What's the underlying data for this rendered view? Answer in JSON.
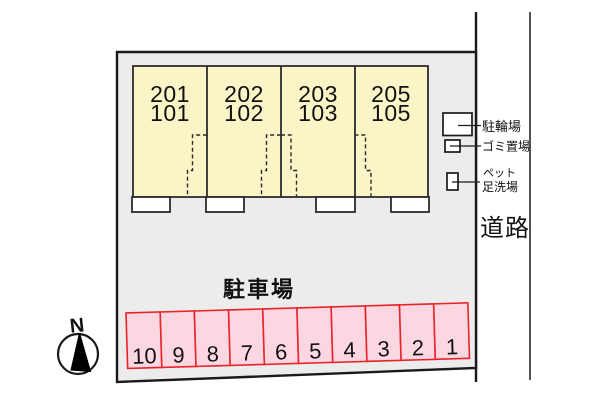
{
  "diagram": {
    "compass": {
      "north_label": "N"
    },
    "road": {
      "label": "道路"
    },
    "building": {
      "units": [
        {
          "upper": "201",
          "lower": "101"
        },
        {
          "upper": "202",
          "lower": "102"
        },
        {
          "upper": "203",
          "lower": "103"
        },
        {
          "upper": "205",
          "lower": "105"
        }
      ]
    },
    "facilities": {
      "bicycle": {
        "label": "駐輪場"
      },
      "garbage": {
        "label": "ゴミ置場"
      },
      "pet_wash": {
        "label_line1": "ペット",
        "label_line2": "足洗場"
      }
    },
    "parking": {
      "label": "駐車場",
      "space_numbers": [
        "10",
        "9",
        "8",
        "7",
        "6",
        "5",
        "4",
        "3",
        "2",
        "1"
      ]
    }
  },
  "colors": {
    "site-fill": "#ececec",
    "line": "#1a1a1a",
    "building-fill": "#faf4c6",
    "parking-fill": "#fcd7e2",
    "parking-stroke": "#e8242b",
    "text": "#111111"
  }
}
